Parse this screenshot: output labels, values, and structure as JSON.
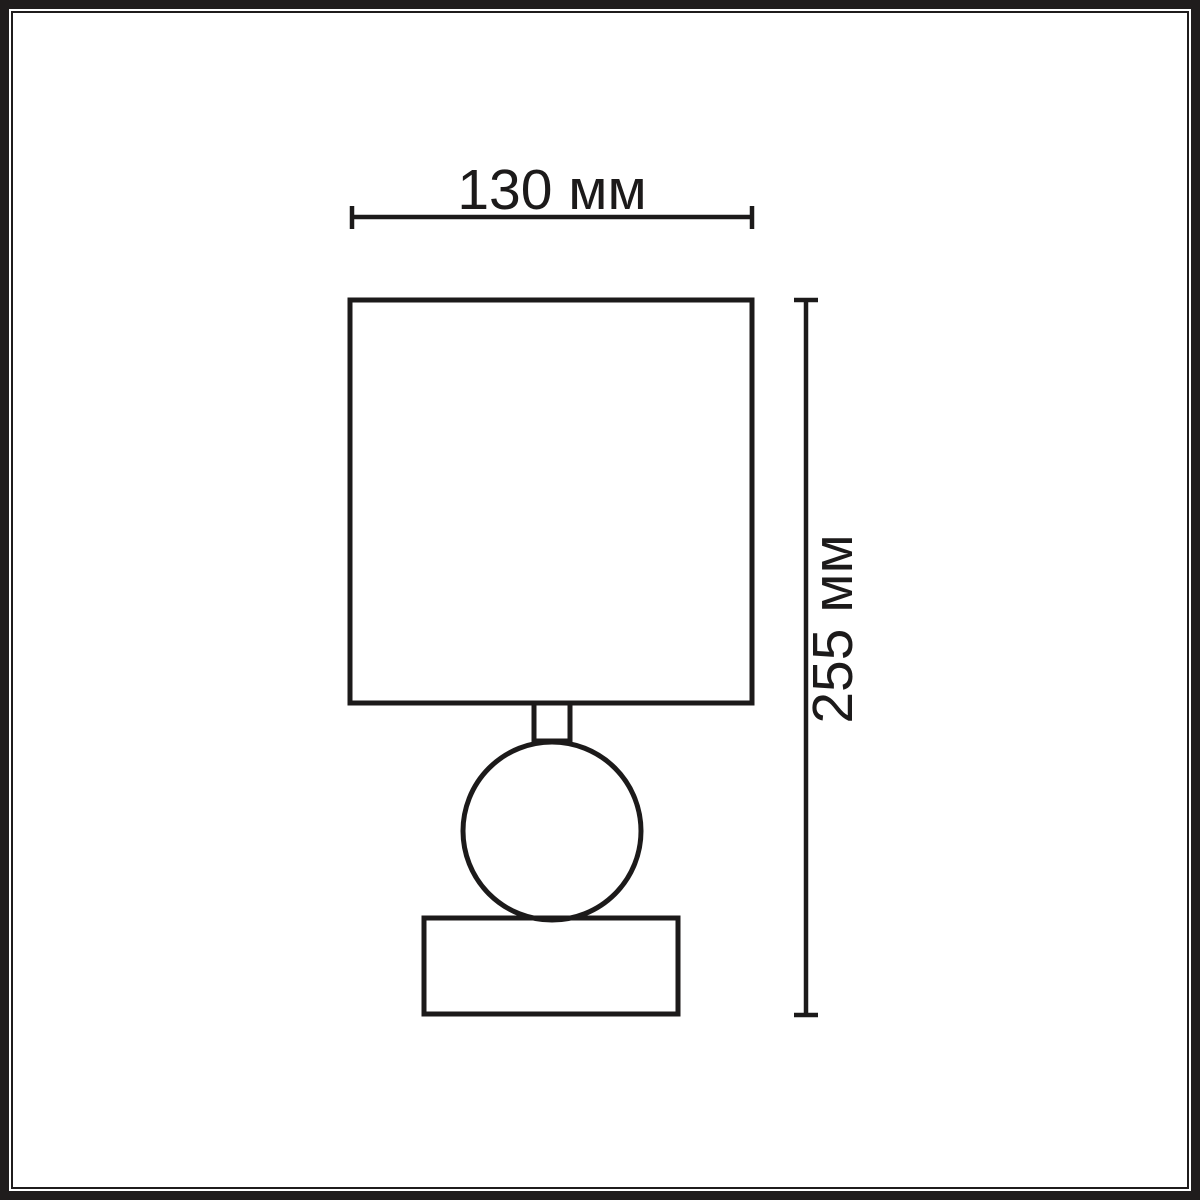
{
  "diagram": {
    "title": "table-lamp dimension drawing",
    "line_color": "#1c1a1a",
    "background_color": "#ffffff",
    "width_dimension": {
      "label": "130 мм",
      "value_mm": 130
    },
    "height_dimension": {
      "label": "255 мм",
      "value_mm": 255
    }
  }
}
